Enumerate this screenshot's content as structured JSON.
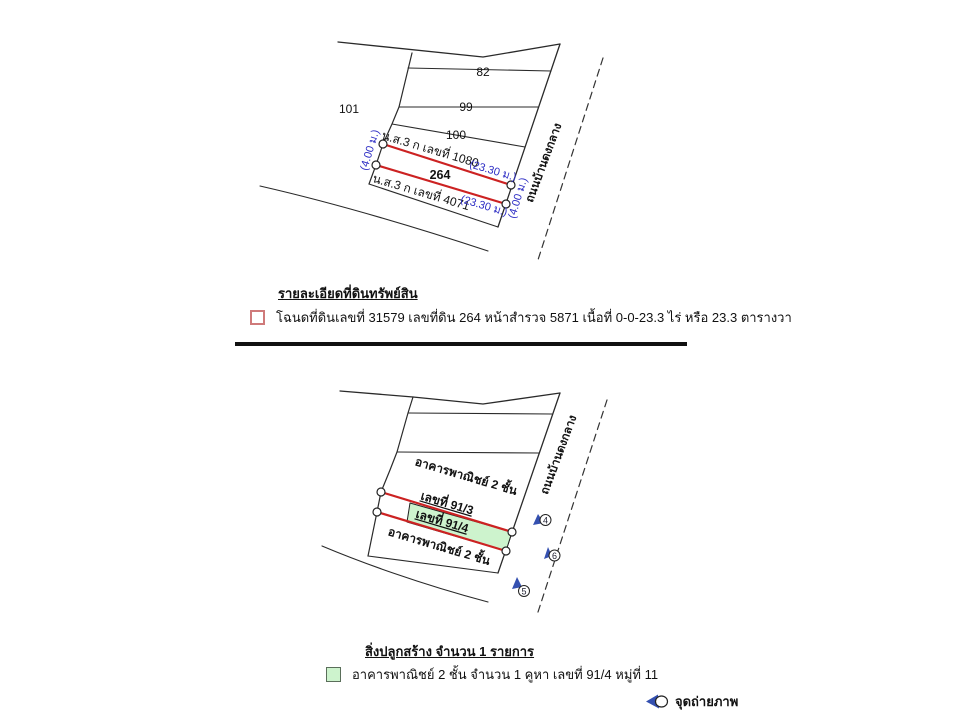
{
  "top_map": {
    "neighbor_plots": {
      "far_left": "101",
      "row1": "82",
      "row2": "99",
      "row3": "100"
    },
    "subject_plot_number": "264",
    "boundary_doc_top": "น.ส.3 ก เลขที่ 1080",
    "boundary_doc_bottom": "น.ส.3 ก เลขที่ 4071",
    "dim_top": "(23.30 ม.)",
    "dim_bottom": "(23.30 ม.)",
    "dim_left": "(4.00 ม.)",
    "dim_right": "(4.00 ม.)",
    "road_name": "ถนนบ้านดงกลาง"
  },
  "land_legend": {
    "heading": "รายละเอียดที่ดินทรัพย์สิน",
    "item_text": "โฉนดที่ดินเลขที่ 31579 เลขที่ดิน 264 หน้าสำรวจ 5871 เนื้อที่ 0-0-23.3 ไร่ หรือ 23.3 ตารางวา"
  },
  "building_map": {
    "upper_building_line1": "อาคารพาณิชย์ 2 ชั้น",
    "upper_building_line2": "เลขที่ 91/3",
    "subject_building_label": "เลขที่ 91/4",
    "lower_building_label": "อาคารพาณิชย์ 2 ชั้น",
    "road_name": "ถนนบ้านดงกลาง",
    "photo_point_1": "4",
    "photo_point_2": "6",
    "photo_point_3": "5"
  },
  "building_legend": {
    "heading": "สิ่งปลูกสร้าง จำนวน 1 รายการ",
    "item_text": "อาคารพาณิชย์ 2 ชั้น จำนวน 1 คูหา เลขที่ 91/4 หมู่ที่ 11",
    "photo_point_label": "จุดถ่ายภาพ"
  },
  "colors": {
    "parcel_outline_red": "#cc2222",
    "dimension_text_blue": "#2d2dc4",
    "building_fill_green": "#cdf3cd",
    "land_swatch_border": "#cf7a7a",
    "marker_blue": "#3450b0",
    "line_black": "#2a2a2a"
  }
}
